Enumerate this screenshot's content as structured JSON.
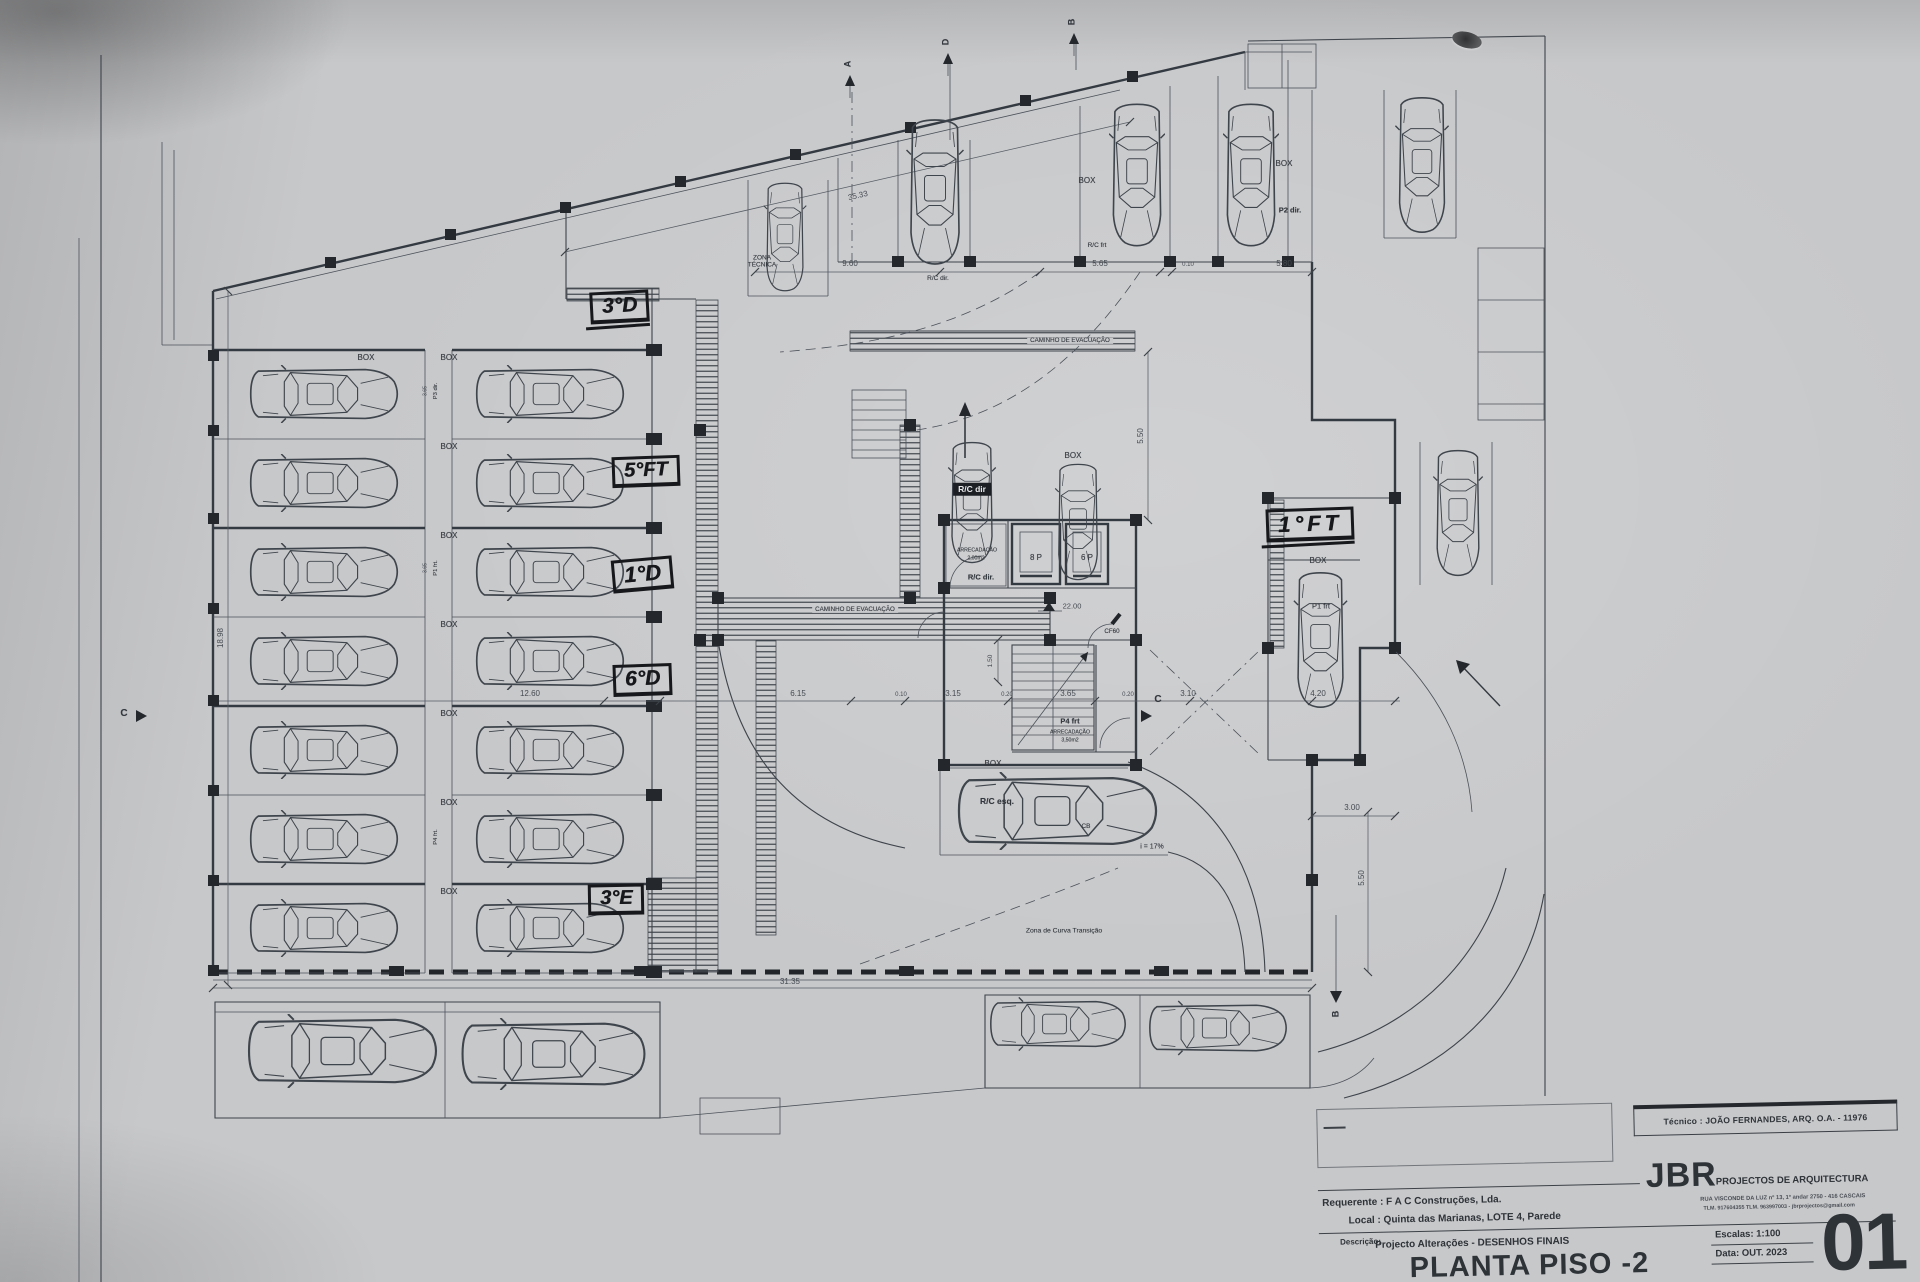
{
  "paper": {
    "bg": "#c7c8ca",
    "ink": "#31363c",
    "marker_ink": "#17181b"
  },
  "title_block": {
    "tecnico": "Técnico : JOÃO FERNANDES, ARQ.   O.A. - 11976",
    "brand": "JBR",
    "brand_tagline": "PROJECTOS DE ARQUITECTURA",
    "address_line1": "RUA VISCONDE DA LUZ nº 13, 1º andar  2750 - 416  CASCAIS",
    "address_line2": "TLM. 917604355  TLM. 963997003 - jbrprojectos@gmail.com",
    "requerente": "Requerente : F A C  Construções, Lda.",
    "local": "Local : Quinta das Marianas, LOTE 4, Parede",
    "descricao_label": "Descrição:",
    "descricao": "Projecto Alterações - DESENHOS FINAIS",
    "drawing_title": "PLANTA PISO -2",
    "escalas": "Escalas:  1:100",
    "data": "Data: OUT.  2023",
    "sheet_number": "01"
  },
  "handwritten": {
    "tag_3d": "3°D",
    "tag_5ft": "5°FT",
    "tag_1d": "1°D",
    "tag_6d": "6°D",
    "tag_3e": "3°E",
    "tag_1ft": "1°FT"
  },
  "labels": {
    "zona1": "ZONA",
    "zona2": "TÉCNICA",
    "caminho": "CAMINHO DE EVACUAÇÃO",
    "box": "BOX",
    "rc_frt": "R/C frt",
    "p2_dir": "P2 dir.",
    "rc_dir_top": "R/C dir.",
    "arrecadacao": "ARRECADAÇÃO",
    "area_2": "2,00m2",
    "rc_dir_core": "R/C dir.",
    "lift8": "8 P",
    "lift6": "6 P",
    "cf60": "CF60",
    "p4_frt": "P4 frt",
    "area_3": "3,50m2",
    "rc_dir_badge": "R/C dir",
    "p1_frt": "P1 frt",
    "rc_esq": "R/C esq.",
    "slope": "i = 17%",
    "curva": "Zona de Curva Transição",
    "cb": "CB",
    "p3_dir_small": "P3 dir.",
    "p1_frt_small": "P1 frt.",
    "p4_frt_small": "P4 frt."
  },
  "markers": {
    "a": "A",
    "b": "B",
    "c": "C",
    "d": "D"
  },
  "dims": {
    "d35_33": "35.33",
    "d9_60": "9.60",
    "d5_65": "5.65",
    "d0_10": "0.10",
    "d5_80": "5.80",
    "d18_98": "18.98",
    "d12_60": "12.60",
    "d6_15": "6.15",
    "d3_15": "3.15",
    "d0_20": "0.20",
    "d3_65": "3.65",
    "d3_10": "3.10",
    "d4_20": "4.20",
    "d3_00": "3.00",
    "d5_50": "5.50",
    "d1_50": "1.50",
    "d31_35": "31.35",
    "level": "22.00"
  }
}
